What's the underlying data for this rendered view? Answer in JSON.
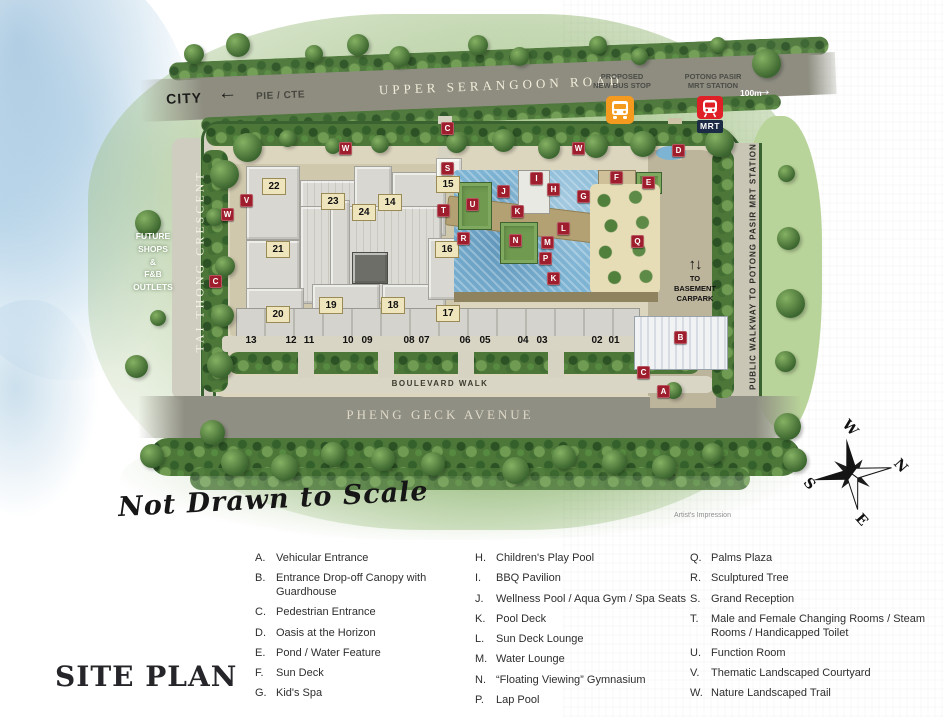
{
  "title": "SITE PLAN",
  "disclaimers": {
    "not_to_scale": "Not Drawn to Scale",
    "artists_impression": "Artist's Impression"
  },
  "top": {
    "city": "CITY",
    "city_arrow": "←",
    "expressway": "PIE / CTE",
    "main_road": "UPPER SERANGOON ROAD",
    "bus_stop_line1": "PROPOSED",
    "bus_stop_line2": "NEW BUS STOP",
    "mrt_line1": "POTONG PASIR",
    "mrt_line2": "MRT STATION",
    "mrt_badge": "MRT",
    "mrt_distance": "100m",
    "mrt_arrow": "→"
  },
  "map": {
    "left_road": "TAI THONG CRESCENT",
    "future_shops_lines": [
      "FUTURE",
      "SHOPS",
      "&",
      "F&B",
      "OUTLETS"
    ],
    "right_walkway": "PUBLIC WALKWAY TO POTONG PASIR MRT STATION",
    "boulevard_walk": "BOULEVARD WALK",
    "avenue": "PHENG GECK AVENUE",
    "basement_arrows": "↑↓",
    "basement_lines": [
      "TO",
      "BASEMENT",
      "CARPARK"
    ],
    "compass": {
      "top": "W",
      "right": "N",
      "left": "S",
      "bottom": "E"
    },
    "markers": [
      {
        "letter": "C",
        "x": 447,
        "y": 128
      },
      {
        "letter": "W",
        "x": 345,
        "y": 148
      },
      {
        "letter": "W",
        "x": 578,
        "y": 148
      },
      {
        "letter": "D",
        "x": 678,
        "y": 150
      },
      {
        "letter": "S",
        "x": 447,
        "y": 168
      },
      {
        "letter": "F",
        "x": 616,
        "y": 177
      },
      {
        "letter": "I",
        "x": 536,
        "y": 178
      },
      {
        "letter": "E",
        "x": 648,
        "y": 182
      },
      {
        "letter": "H",
        "x": 553,
        "y": 189
      },
      {
        "letter": "J",
        "x": 503,
        "y": 191
      },
      {
        "letter": "G",
        "x": 583,
        "y": 196
      },
      {
        "letter": "V",
        "x": 246,
        "y": 200
      },
      {
        "letter": "U",
        "x": 472,
        "y": 204
      },
      {
        "letter": "T",
        "x": 443,
        "y": 210
      },
      {
        "letter": "K",
        "x": 517,
        "y": 211
      },
      {
        "letter": "W",
        "x": 227,
        "y": 214
      },
      {
        "letter": "L",
        "x": 563,
        "y": 228
      },
      {
        "letter": "R",
        "x": 463,
        "y": 238
      },
      {
        "letter": "N",
        "x": 515,
        "y": 240
      },
      {
        "letter": "Q",
        "x": 637,
        "y": 241
      },
      {
        "letter": "M",
        "x": 547,
        "y": 242
      },
      {
        "letter": "P",
        "x": 545,
        "y": 258
      },
      {
        "letter": "K",
        "x": 553,
        "y": 278
      },
      {
        "letter": "C",
        "x": 215,
        "y": 281
      },
      {
        "letter": "B",
        "x": 680,
        "y": 337
      },
      {
        "letter": "C",
        "x": 643,
        "y": 372
      },
      {
        "letter": "A",
        "x": 663,
        "y": 391
      }
    ],
    "towers": [
      {
        "num": "22",
        "x": 273,
        "y": 186
      },
      {
        "num": "15",
        "x": 447,
        "y": 184
      },
      {
        "num": "23",
        "x": 332,
        "y": 201
      },
      {
        "num": "14",
        "x": 389,
        "y": 202
      },
      {
        "num": "24",
        "x": 363,
        "y": 212
      },
      {
        "num": "21",
        "x": 277,
        "y": 249
      },
      {
        "num": "16",
        "x": 446,
        "y": 249
      },
      {
        "num": "19",
        "x": 330,
        "y": 305
      },
      {
        "num": "18",
        "x": 392,
        "y": 305
      },
      {
        "num": "20",
        "x": 277,
        "y": 314
      },
      {
        "num": "17",
        "x": 447,
        "y": 313
      }
    ],
    "units": [
      {
        "num": "13",
        "x": 251,
        "y": 341
      },
      {
        "num": "12",
        "x": 291,
        "y": 341
      },
      {
        "num": "11",
        "x": 309,
        "y": 341
      },
      {
        "num": "10",
        "x": 348,
        "y": 341
      },
      {
        "num": "09",
        "x": 367,
        "y": 341
      },
      {
        "num": "08",
        "x": 409,
        "y": 341
      },
      {
        "num": "07",
        "x": 424,
        "y": 341
      },
      {
        "num": "06",
        "x": 465,
        "y": 341
      },
      {
        "num": "05",
        "x": 485,
        "y": 341
      },
      {
        "num": "04",
        "x": 523,
        "y": 341
      },
      {
        "num": "03",
        "x": 542,
        "y": 341
      },
      {
        "num": "02",
        "x": 597,
        "y": 341
      },
      {
        "num": "01",
        "x": 614,
        "y": 341
      }
    ]
  },
  "legend": {
    "columns": [
      [
        {
          "key": "A.",
          "label": "Vehicular Entrance"
        },
        {
          "key": "B.",
          "label": "Entrance Drop-off Canopy with Guardhouse"
        },
        {
          "key": "C.",
          "label": "Pedestrian Entrance"
        },
        {
          "key": "D.",
          "label": "Oasis at the Horizon"
        },
        {
          "key": "E.",
          "label": "Pond / Water Feature"
        },
        {
          "key": "F.",
          "label": "Sun Deck"
        },
        {
          "key": "G.",
          "label": "Kid's Spa"
        }
      ],
      [
        {
          "key": "H.",
          "label": "Children's Play Pool"
        },
        {
          "key": "I.",
          "label": "BBQ Pavilion"
        },
        {
          "key": "J.",
          "label": "Wellness Pool / Aqua Gym / Spa Seats"
        },
        {
          "key": "K.",
          "label": "Pool Deck"
        },
        {
          "key": "L.",
          "label": "Sun Deck Lounge"
        },
        {
          "key": "M.",
          "label": "Water Lounge"
        },
        {
          "key": "N.",
          "label": "“Floating Viewing” Gymnasium"
        },
        {
          "key": "P.",
          "label": "Lap Pool"
        }
      ],
      [
        {
          "key": "Q.",
          "label": "Palms Plaza"
        },
        {
          "key": "R.",
          "label": "Sculptured Tree"
        },
        {
          "key": "S.",
          "label": "Grand Reception"
        },
        {
          "key": "T.",
          "label": "Male and Female Changing Rooms / Steam Rooms / Handicapped Toilet"
        },
        {
          "key": "U.",
          "label": "Function Room"
        },
        {
          "key": "V.",
          "label": "Thematic Landscaped Courtyard"
        },
        {
          "key": "W.",
          "label": "Nature Landscaped Trail"
        }
      ]
    ]
  },
  "colors": {
    "marker_red": "#9E1E2D",
    "bus_orange": "#F49A1F",
    "mrt_red": "#DF2027",
    "mrt_navy": "#1C2B45",
    "pool_blue": "#7DB3D3"
  }
}
